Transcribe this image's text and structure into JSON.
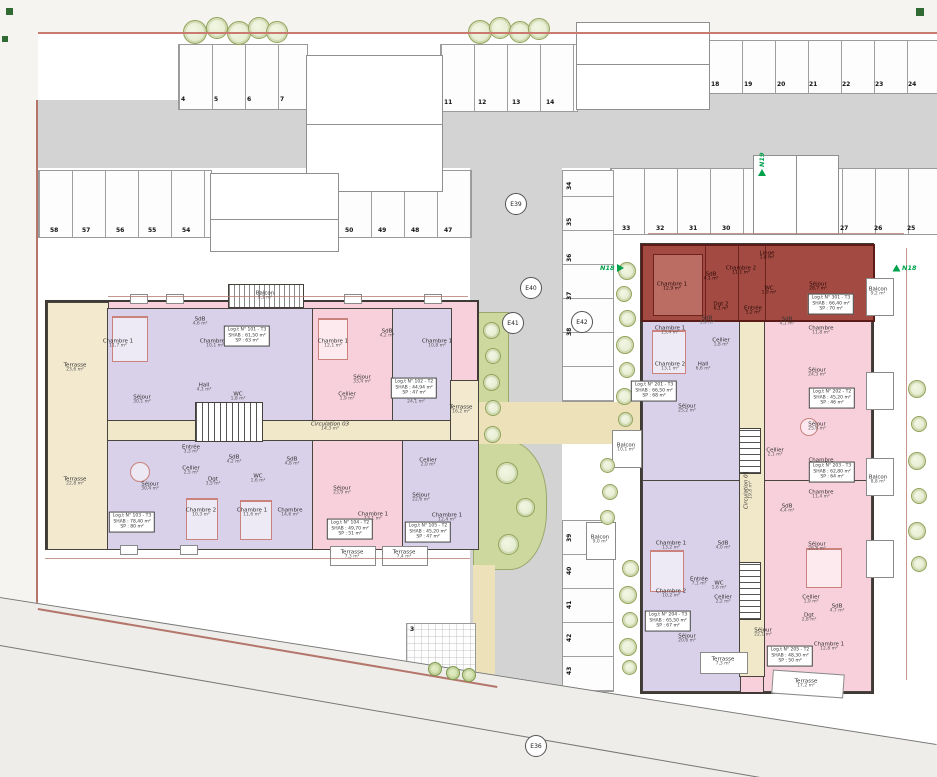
{
  "markers": {
    "e36": "E36",
    "e39": "E39",
    "e40": "E40",
    "e41": "E41",
    "e42": "E42"
  },
  "flags": {
    "n19": "N19",
    "n18a": "N18",
    "n18b": "N18"
  },
  "parking": {
    "top_left": [
      "4",
      "5",
      "6",
      "7"
    ],
    "top_mid": [
      "11",
      "12",
      "13",
      "14"
    ],
    "top_right": [
      "18",
      "19",
      "20",
      "21",
      "22",
      "23",
      "24"
    ],
    "mid_left": [
      "58",
      "57",
      "56",
      "55",
      "54"
    ],
    "mid_center": [
      "50",
      "49",
      "48",
      "47"
    ],
    "right_a": [
      "33",
      "32",
      "31",
      "30"
    ],
    "right_b": [
      "27",
      "26",
      "25"
    ],
    "col_upper": [
      "34",
      "35",
      "36",
      "37",
      "38"
    ],
    "col_lower": [
      "39",
      "40",
      "41",
      "42",
      "43"
    ],
    "pad": "3"
  },
  "lb": {
    "balcony": {
      "t": "Balcon",
      "a": "9,1 m²"
    },
    "corridor": {
      "t": "Circulation 03",
      "a": "14,3 m²"
    },
    "terraces": {
      "lt": {
        "t": "Terrasse",
        "a": "23,6 m²"
      },
      "lbm": {
        "t": "Terrasse",
        "a": "22,8 m²"
      },
      "right": {
        "t": "Terrasse",
        "a": "16,2 m²"
      },
      "ba": {
        "t": "Terrasse",
        "a": "7,3 m²"
      },
      "bb": {
        "t": "Terrasse",
        "a": "7,4 m²"
      }
    },
    "rooms": [
      {
        "t": "Chambre 1",
        "a": "11,7 m²"
      },
      {
        "t": "SdB",
        "a": "4,6 m²"
      },
      {
        "t": "Chambre 2",
        "a": "10,1 m²"
      },
      {
        "t": "Hall",
        "a": "4,1 m²"
      },
      {
        "t": "WC",
        "a": "1,8 m²"
      },
      {
        "t": "Séjour",
        "a": "30,1 m²"
      },
      {
        "t": "Chambre 1",
        "a": "12,1 m²"
      },
      {
        "t": "SdB",
        "a": "4,2 m²"
      },
      {
        "t": "Cellier",
        "a": "1,9 m²"
      },
      {
        "t": "Séjour",
        "a": "33,4 m²"
      },
      {
        "t": "Chambre 1",
        "a": "10,8 m²"
      },
      {
        "t": "Séjour",
        "a": "24,1 m²"
      },
      {
        "t": "Entrée",
        "a": "3,3 m²"
      },
      {
        "t": "Cellier",
        "a": "2,5 m²"
      },
      {
        "t": "Dgt",
        "a": "3,5 m²"
      },
      {
        "t": "SdB",
        "a": "4,2 m²"
      },
      {
        "t": "WC",
        "a": "1,6 m²"
      },
      {
        "t": "Séjour",
        "a": "30,4 m²"
      },
      {
        "t": "Chambre 2",
        "a": "10,3 m²"
      },
      {
        "t": "Chambre 1",
        "a": "11,6 m²"
      },
      {
        "t": "SdB",
        "a": "4,8 m²"
      },
      {
        "t": "Chambre",
        "a": "14,6 m²"
      },
      {
        "t": "Séjour",
        "a": "23,9 m²"
      },
      {
        "t": "Chambre 1",
        "a": "13,1 m²"
      },
      {
        "t": "Cellier",
        "a": "2,0 m²"
      },
      {
        "t": "Séjour",
        "a": "22,6 m²"
      },
      {
        "t": "Chambre 1",
        "a": "12,4 m²"
      }
    ],
    "units": [
      {
        "l1": "Log.t N° 101 - T3",
        "l2": "SHAB : 61,50 m²",
        "l3": "SP : 63 m²"
      },
      {
        "l1": "Log.t N° 102 - T2",
        "l2": "SHAB : 44,94 m²",
        "l3": "SP : 47 m²"
      },
      {
        "l1": "Log.t N° 103 - T3",
        "l2": "SHAB : 78,40 m²",
        "l3": "SP : 80 m²"
      },
      {
        "l1": "Log.t N° 104 - T2",
        "l2": "SHAB : 49,70 m²",
        "l3": "SP : 51 m²"
      },
      {
        "l1": "Log.t N° 105 - T2",
        "l2": "SHAB : 45,20 m²",
        "l3": "SP : 47 m²"
      }
    ]
  },
  "rb": {
    "corridor": {
      "t": "Circulation 01",
      "a": "19,8 m²"
    },
    "red": {
      "rooms": [
        {
          "t": "Chambre 1",
          "a": "12,9 m²"
        },
        {
          "t": "SdB",
          "a": "4,1 m²"
        },
        {
          "t": "Chambre 2",
          "a": "11,1 m²"
        },
        {
          "t": "Linge",
          "a": "1,8 m²"
        },
        {
          "t": "WC",
          "a": "1,9 m²"
        },
        {
          "t": "Dgt 2",
          "a": "6,1 m²"
        },
        {
          "t": "Entrée",
          "a": "5,2 m²"
        },
        {
          "t": "Séjour",
          "a": "28,7 m²"
        }
      ],
      "label": {
        "l1": "Log.t N° 301 - T3",
        "l2": "SHAB : 66,40 m²",
        "l3": "SP : 70 m²"
      }
    },
    "rooms": [
      {
        "t": "Chambre 1",
        "a": "13,4 m²"
      },
      {
        "t": "SdB",
        "a": "3,9 m²"
      },
      {
        "t": "Cellier",
        "a": "1,8 m²"
      },
      {
        "t": "Hall",
        "a": "6,6 m²"
      },
      {
        "t": "Chambre 2",
        "a": "13,1 m²"
      },
      {
        "t": "Séjour",
        "a": "25,2 m²"
      },
      {
        "t": "SdB",
        "a": "4,1 m²"
      },
      {
        "t": "Chambre",
        "a": "11,8 m²"
      },
      {
        "t": "Séjour",
        "a": "24,3 m²"
      },
      {
        "t": "Séjour",
        "a": "25,6 m²"
      },
      {
        "t": "Cellier",
        "a": "2,1 m²"
      },
      {
        "t": "Chambre",
        "a": "12,2 m²"
      },
      {
        "t": "Chambre",
        "a": "11,4 m²"
      },
      {
        "t": "SdB",
        "a": "4,4 m²"
      },
      {
        "t": "Séjour",
        "a": "26,8 m²"
      },
      {
        "t": "Chambre 1",
        "a": "13,2 m²"
      },
      {
        "t": "SdB",
        "a": "4,0 m²"
      },
      {
        "t": "Chambre 2",
        "a": "10,2 m²"
      },
      {
        "t": "Entrée",
        "a": "7,1 m²"
      },
      {
        "t": "WC",
        "a": "1,6 m²"
      },
      {
        "t": "Cellier",
        "a": "2,2 m²"
      },
      {
        "t": "Séjour",
        "a": "20,6 m²"
      },
      {
        "t": "Séjour",
        "a": "22,1 m²"
      },
      {
        "t": "Cellier",
        "a": "1,9 m²"
      },
      {
        "t": "SdB",
        "a": "4,7 m²"
      },
      {
        "t": "Dgt",
        "a": "2,8 m²"
      },
      {
        "t": "Chambre 1",
        "a": "12,8 m²"
      }
    ],
    "units": [
      {
        "l1": "Log.t N° 201 - T3",
        "l2": "SHAB : 66,50 m²",
        "l3": "SP : 68 m²"
      },
      {
        "l1": "Log.t N° 202 - T2",
        "l2": "SHAB : 45,20 m²",
        "l3": "SP : 46 m²"
      },
      {
        "l1": "Log.t N° 203 - T3",
        "l2": "SHAB : 62,80 m²",
        "l3": "SP : 64 m²"
      },
      {
        "l1": "Log.t N° 204 - T3",
        "l2": "SHAB : 65,50 m²",
        "l3": "SP : 67 m²"
      },
      {
        "l1": "Log.t N° 205 - T2",
        "l2": "SHAB : 48,30 m²",
        "l3": "SP : 50 m²"
      }
    ],
    "balconies": [
      {
        "t": "Balcon",
        "a": "9,2 m²"
      },
      {
        "t": "Balcon",
        "a": "8,8 m²"
      },
      {
        "t": "Balcon",
        "a": "10,1 m²"
      },
      {
        "t": "Balcon",
        "a": "9,0 m²"
      }
    ],
    "terraces": [
      {
        "t": "Terrasse",
        "a": "7,3 m²"
      },
      {
        "t": "Terrasse",
        "a": "17,2 m²"
      }
    ]
  }
}
